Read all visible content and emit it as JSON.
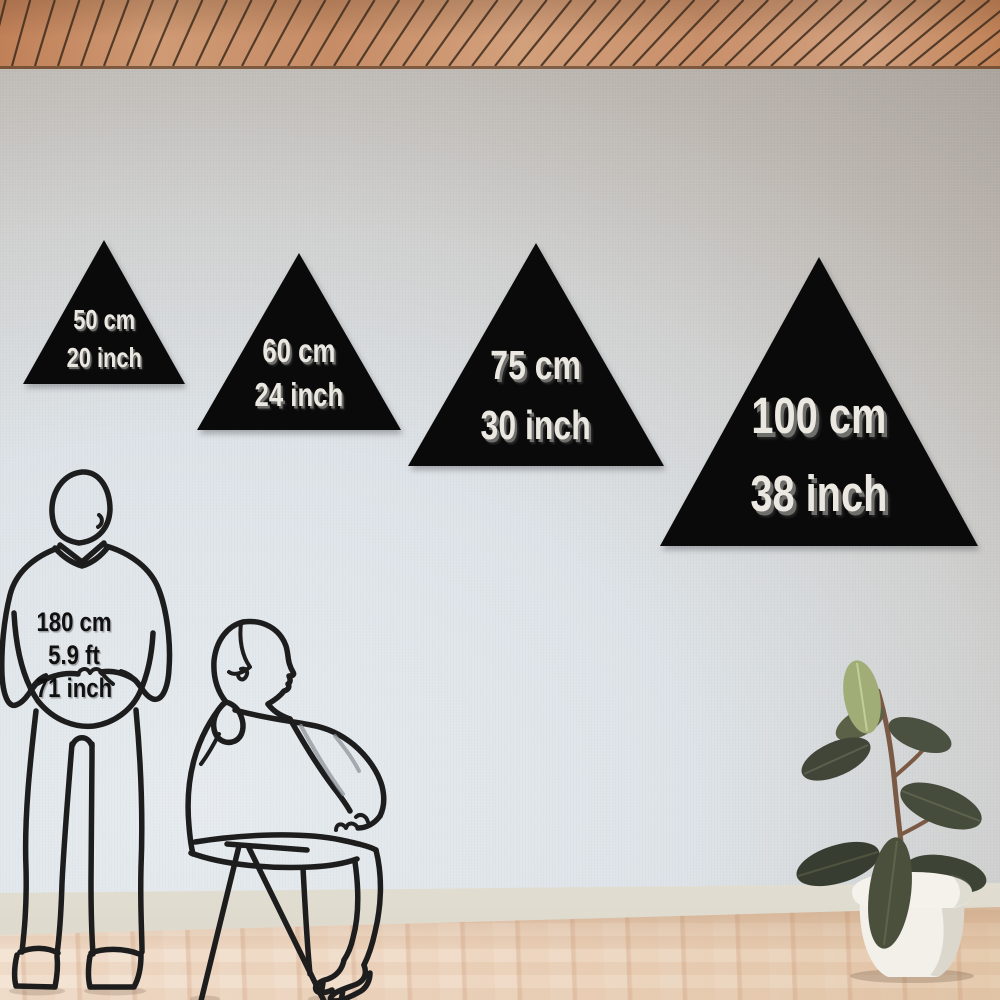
{
  "product_sizes": [
    {
      "cm": "50 cm",
      "inch": "20 inch"
    },
    {
      "cm": "60 cm",
      "inch": "24 inch"
    },
    {
      "cm": "75 cm",
      "inch": "30 inch"
    },
    {
      "cm": "100 cm",
      "inch": "38 inch"
    }
  ],
  "reference_person": {
    "cm": "180 cm",
    "ft": "5.9 ft",
    "inch": "71 inch"
  },
  "colors": {
    "panel": "#0a0a0a",
    "panelText": "#ebe8e1",
    "panelTextShadow": "#6e6e6b",
    "figureLine": "#1d1d1d",
    "heightText": "#101010",
    "wallLight": "#e4e9ed",
    "wallDark": "#a8a29b",
    "ceilingWood": "#c98f6c",
    "ceilingGap": "#3f2d1e",
    "floorWood": "#eed9c5",
    "baseboard": "#f3f4f1",
    "pot": "#f4f2eb",
    "soil": "#5e4a3c",
    "leafDark": "#3c4233",
    "leafLight": "#a0ad77",
    "stem": "#7b5a45"
  }
}
